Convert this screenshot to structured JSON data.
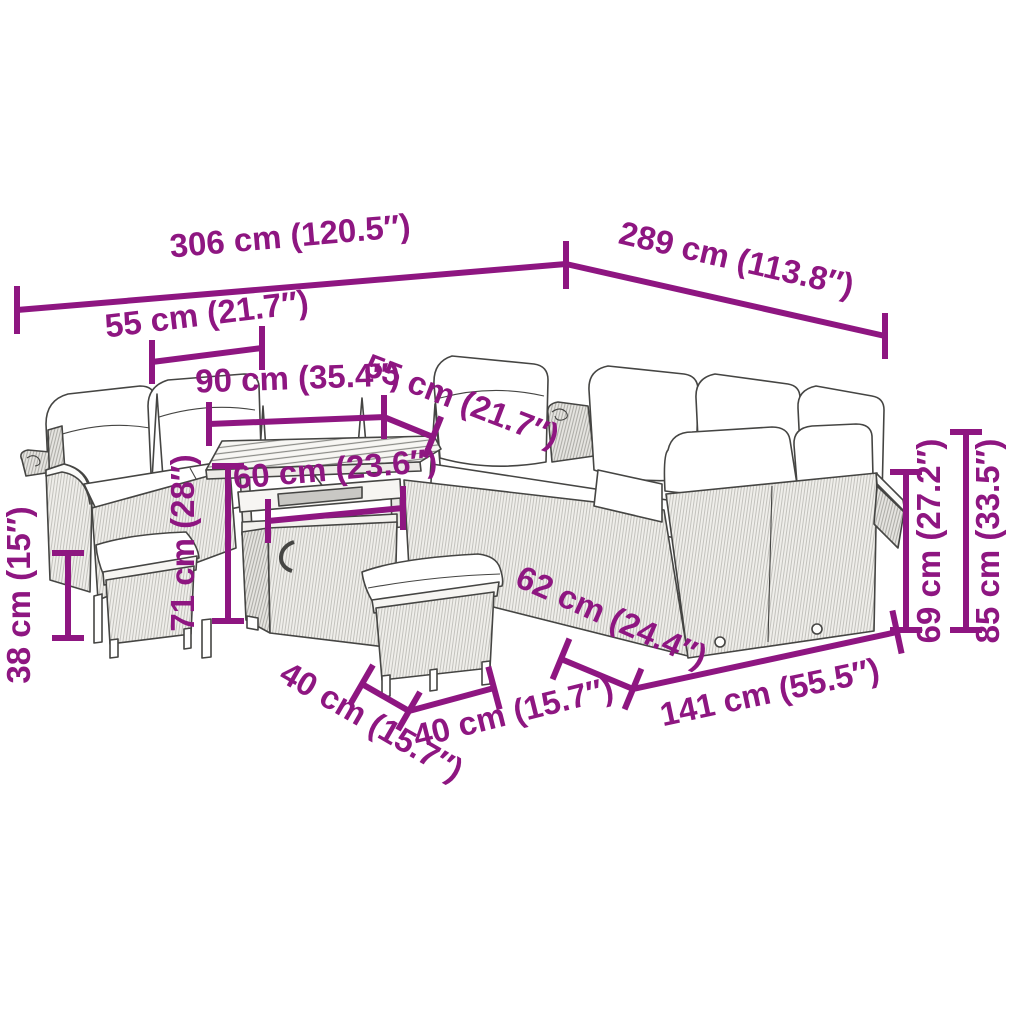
{
  "diagram": {
    "kind": "product-dimension-diagram",
    "subject": "garden-lounge-set-with-storage-table-and-stools",
    "accent_color": "#8E1681",
    "line_color": "#454543",
    "background_color": "#FFFFFF",
    "unit_primary": "cm",
    "unit_secondary": "inch",
    "dimensions": [
      {
        "id": "back-row-total-width",
        "cm": 306,
        "inch": 120.5,
        "label": "306 cm (120.5″)"
      },
      {
        "id": "right-side-total-depth",
        "cm": 289,
        "inch": 113.8,
        "label": "289 cm (113.8″)"
      },
      {
        "id": "left-seat-width",
        "cm": 55,
        "inch": 21.7,
        "label": "55 cm (21.7″)"
      },
      {
        "id": "table-top-width",
        "cm": 90,
        "inch": 35.4,
        "label": "90 cm (35.4″)"
      },
      {
        "id": "back-seat-width",
        "cm": 55,
        "inch": 21.7,
        "label": "55 cm (21.7″)"
      },
      {
        "id": "table-base-width",
        "cm": 60,
        "inch": 23.6,
        "label": "60 cm (23.6″)"
      },
      {
        "id": "table-height",
        "cm": 71,
        "inch": 28,
        "label": "71 cm (28″)"
      },
      {
        "id": "stool-height",
        "cm": 38,
        "inch": 15,
        "label": "38 cm (15″)"
      },
      {
        "id": "stool-depth",
        "cm": 40,
        "inch": 15.7,
        "label": "40 cm (15.7″)"
      },
      {
        "id": "stool-width",
        "cm": 40,
        "inch": 15.7,
        "label": "40 cm (15.7″)"
      },
      {
        "id": "sofa-depth",
        "cm": 62,
        "inch": 24.4,
        "label": "62 cm (24.4″)"
      },
      {
        "id": "sofa-section-width",
        "cm": 141,
        "inch": 55.5,
        "label": "141 cm (55.5″)"
      },
      {
        "id": "backrest-height",
        "cm": 69,
        "inch": 27.2,
        "label": "69 cm (27.2″)"
      },
      {
        "id": "total-height",
        "cm": 85,
        "inch": 33.5,
        "label": "85 cm (33.5″)"
      }
    ]
  }
}
